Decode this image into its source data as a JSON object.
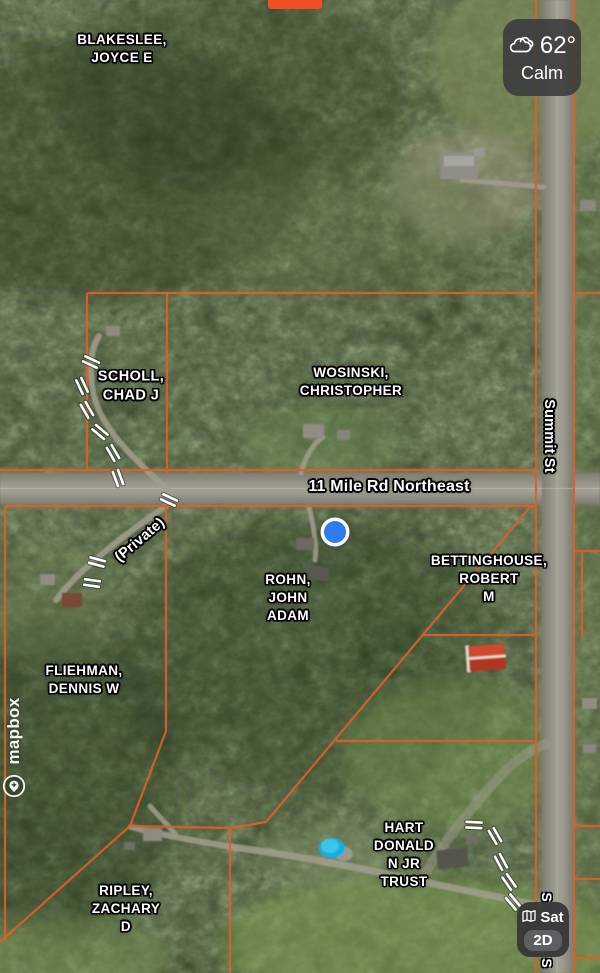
{
  "top_banner": {
    "color": "#f04e23"
  },
  "weather_widget": {
    "temperature": "62°",
    "condition": "Calm"
  },
  "layer_widget": {
    "satellite_label": "Sat",
    "mode_label": "2D"
  },
  "attribution": {
    "logo_text": "mapbox"
  },
  "map": {
    "parcel_line_color": "#de5f28",
    "location_dot_color": "#2f7bf2",
    "road_labels": {
      "main_road": "11 Mile Rd Northeast",
      "cross_street": "Summit St",
      "private_road": "(Private)",
      "occluded_fragment_top": "S",
      "occluded_fragment_bottom": "S"
    },
    "parcels": [
      {
        "owner_lines": [
          "BLAKESLEE,",
          "JOYCE E"
        ]
      },
      {
        "owner_lines": [
          "SCHOLL,",
          "CHAD J"
        ]
      },
      {
        "owner_lines": [
          "WOSINSKI,",
          "CHRISTOPHER"
        ]
      },
      {
        "owner_lines": [
          "ROHN,",
          "JOHN",
          "ADAM"
        ]
      },
      {
        "owner_lines": [
          "BETTINGHOUSE,",
          "ROBERT",
          "M"
        ]
      },
      {
        "owner_lines": [
          "FLIEHMAN,",
          "DENNIS W"
        ]
      },
      {
        "owner_lines": [
          "HART",
          "DONALD",
          "N JR",
          "TRUST"
        ]
      },
      {
        "owner_lines": [
          "RIPLEY,",
          "ZACHARY",
          "D"
        ]
      }
    ]
  }
}
